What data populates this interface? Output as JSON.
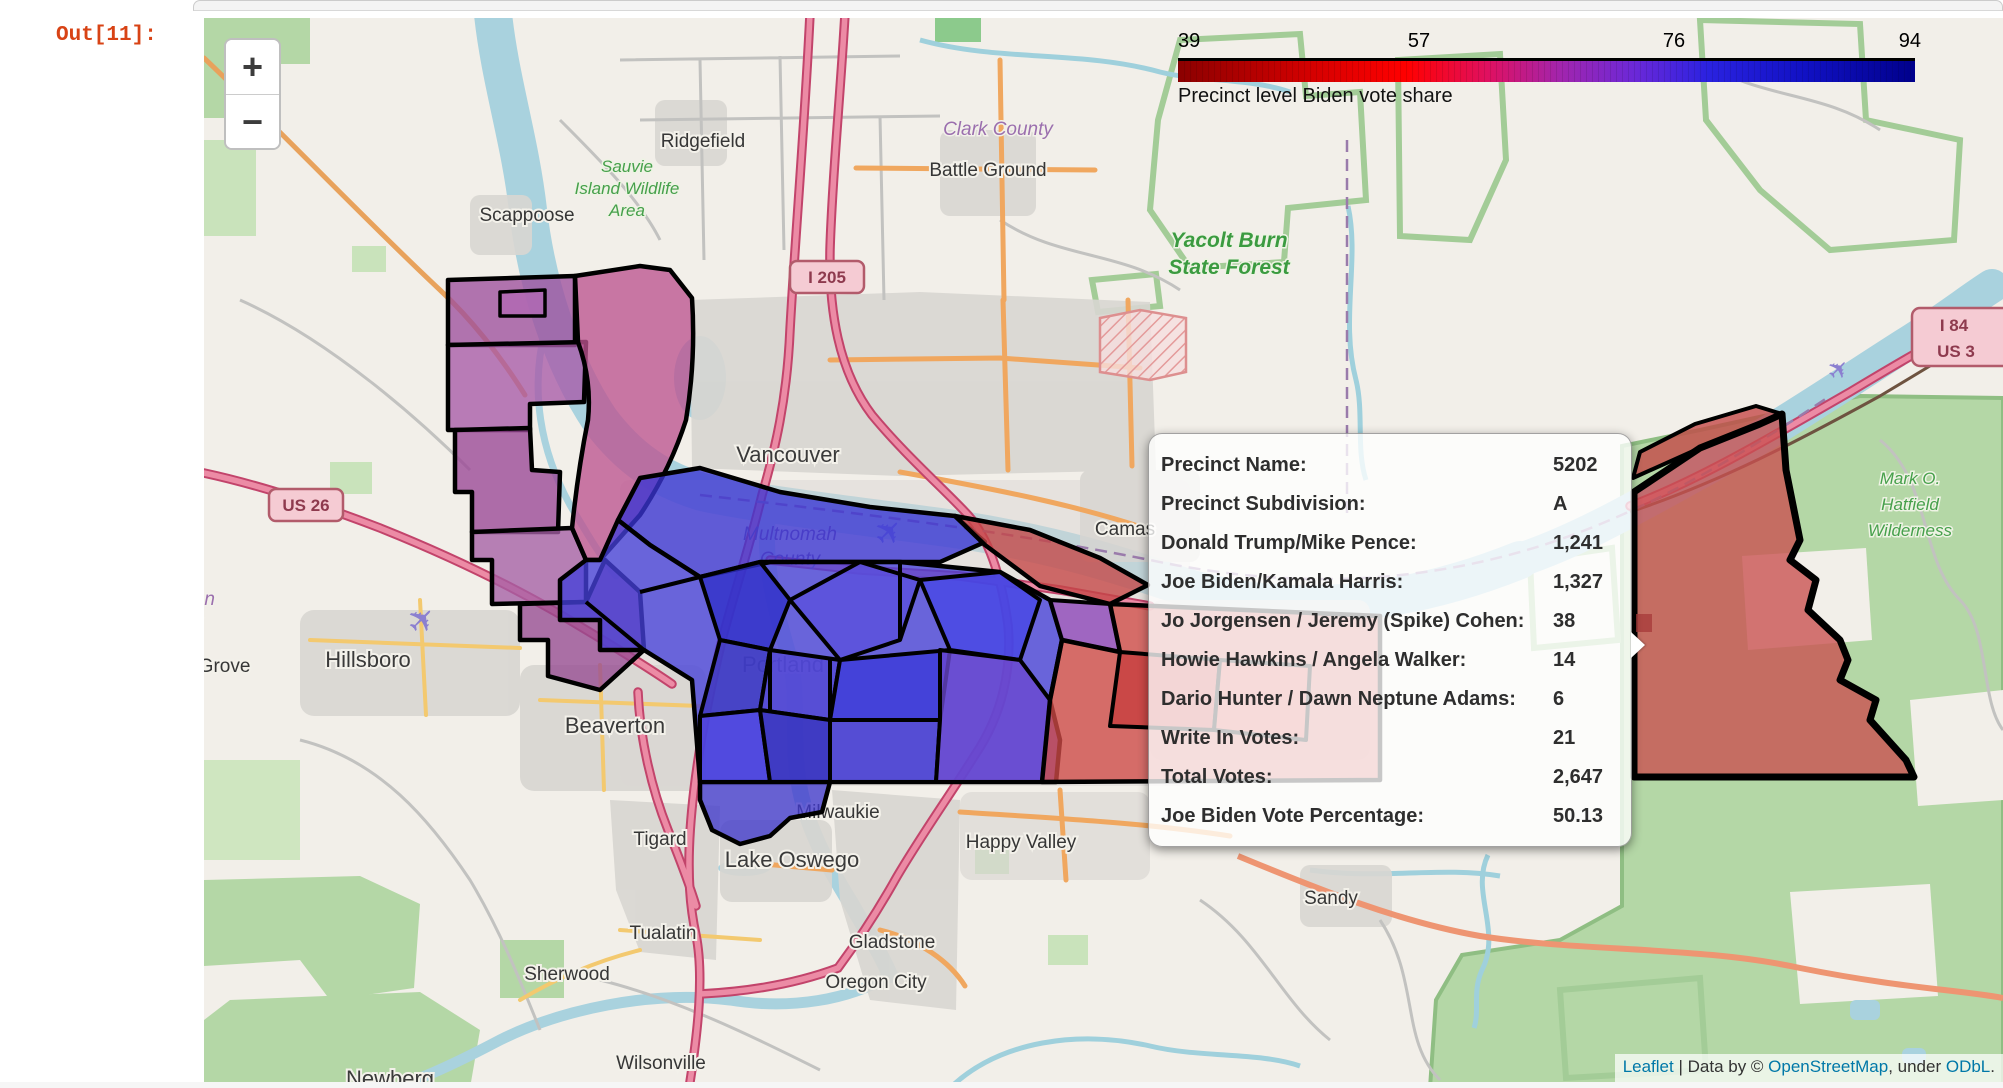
{
  "jupyter": {
    "out_prompt": "Out[11]:"
  },
  "zoom_control": {
    "zoom_in": "+",
    "zoom_out": "−"
  },
  "legend": {
    "ticks": [
      "39",
      "57",
      "76",
      "94"
    ],
    "caption": "Precinct level Biden vote share"
  },
  "tooltip": {
    "rows": [
      {
        "label": "Precinct Name:",
        "value": "5202"
      },
      {
        "label": "Precinct Subdivision:",
        "value": "A"
      },
      {
        "label": "Donald Trump/Mike Pence:",
        "value": "1,241"
      },
      {
        "label": "Joe Biden/Kamala Harris:",
        "value": "1,327"
      },
      {
        "label": "Jo Jorgensen / Jeremy (Spike) Cohen:",
        "value": "38"
      },
      {
        "label": "Howie Hawkins / Angela Walker:",
        "value": "14"
      },
      {
        "label": "Dario Hunter / Dawn Neptune Adams:",
        "value": "6"
      },
      {
        "label": "Write In Votes:",
        "value": "21"
      },
      {
        "label": "Total Votes:",
        "value": "2,647"
      },
      {
        "label": "Joe Biden Vote Percentage:",
        "value": "50.13"
      }
    ]
  },
  "attribution": {
    "leaflet": "Leaflet",
    "separator": " | ",
    "data_by": "Data by © ",
    "osm": "OpenStreetMap",
    "under": ", under ",
    "odbl": "ODbL",
    "period": "."
  },
  "map_labels": [
    {
      "text": "Ridgefield"
    },
    {
      "text": "Clark County"
    },
    {
      "text": "Battle Ground"
    },
    {
      "text": "Sauvie"
    },
    {
      "text": "Island Wildlife"
    },
    {
      "text": "Area"
    },
    {
      "text": "Scappoose"
    },
    {
      "text": "Yacolt Burn"
    },
    {
      "text": "State Forest"
    },
    {
      "text": "Vancouver"
    },
    {
      "text": "Multnomah"
    },
    {
      "text": "County"
    },
    {
      "text": "Camas"
    },
    {
      "text": "Hillsboro"
    },
    {
      "text": "Washington"
    },
    {
      "text": "County"
    },
    {
      "text": "Forest Grove"
    },
    {
      "text": "Beaverton"
    },
    {
      "text": "Portland"
    },
    {
      "text": "Milwaukie"
    },
    {
      "text": "Tigard"
    },
    {
      "text": "Lake Oswego"
    },
    {
      "text": "Happy Valley"
    },
    {
      "text": "Tualatin"
    },
    {
      "text": "Gladstone"
    },
    {
      "text": "Sherwood"
    },
    {
      "text": "Oregon City"
    },
    {
      "text": "Wilsonville"
    },
    {
      "text": "Sandy"
    },
    {
      "text": "Newberg"
    },
    {
      "text": "Mark O."
    },
    {
      "text": "Hatfield"
    },
    {
      "text": "Wilderness"
    },
    {
      "text": "Bull Run"
    },
    {
      "text": "Watershed"
    },
    {
      "text": "Management"
    },
    {
      "text": "Unit"
    },
    {
      "text": "I 205"
    },
    {
      "text": "US 26"
    },
    {
      "text": "I 84"
    },
    {
      "text": "US 3"
    }
  ],
  "colors": {
    "out_prompt": "#d84315",
    "link": "#0078a8",
    "legend_gradient": [
      "#8b0000",
      "#ff0000",
      "#a125ae",
      "#2222dd",
      "#00008b"
    ],
    "water": "#a9d2de",
    "forest": "#b4d7a6",
    "precinct_blue": "#3a35d4",
    "precinct_red": "#c94f4f",
    "precinct_purple": "#9d4f9e"
  }
}
